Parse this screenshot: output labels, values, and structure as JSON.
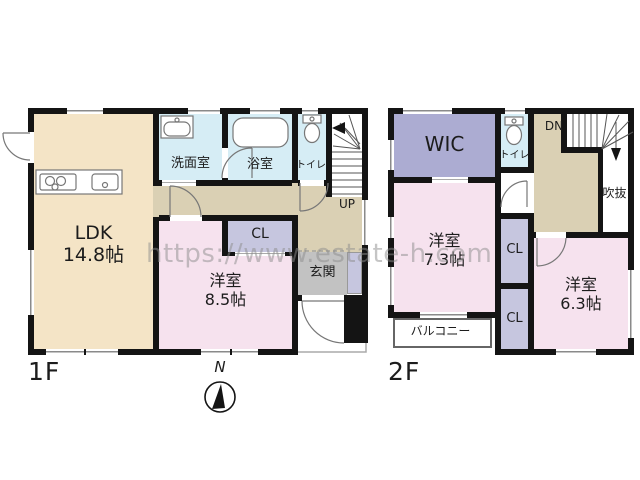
{
  "watermark": "https://www.estate-h.com",
  "compass": {
    "north": "N"
  },
  "colors": {
    "wall": "#141414",
    "ldk_fill": "#F4E4C6",
    "hall_fill": "#DAD0B4",
    "wet_room_fill": "#D6EDF5",
    "bedroom_fill": "#F6E2EE",
    "closet_fill": "#C6C6DF",
    "wic_fill": "#ACACD2",
    "entrance_fill": "#C2C2C2",
    "watermark_gray": "#8d8d8d"
  },
  "floor1": {
    "label": "1F",
    "ldk": {
      "name": "LDK",
      "size": "14.8帖"
    },
    "washroom": "洗面室",
    "bathroom": "浴室",
    "toilet": "トイレ",
    "stairs": "UP",
    "closet": "CL",
    "bedroom": {
      "name": "洋室",
      "size": "8.5帖"
    },
    "entrance": "玄関"
  },
  "floor2": {
    "label": "2F",
    "wic": "WIC",
    "toilet": "トイレ",
    "stairs": "DN",
    "void": "吹抜",
    "bedroom_a": {
      "name": "洋室",
      "size": "7.3帖"
    },
    "closet_a": "CL",
    "closet_b": "CL",
    "bedroom_b": {
      "name": "洋室",
      "size": "6.3帖"
    },
    "balcony": "バルコニー"
  }
}
